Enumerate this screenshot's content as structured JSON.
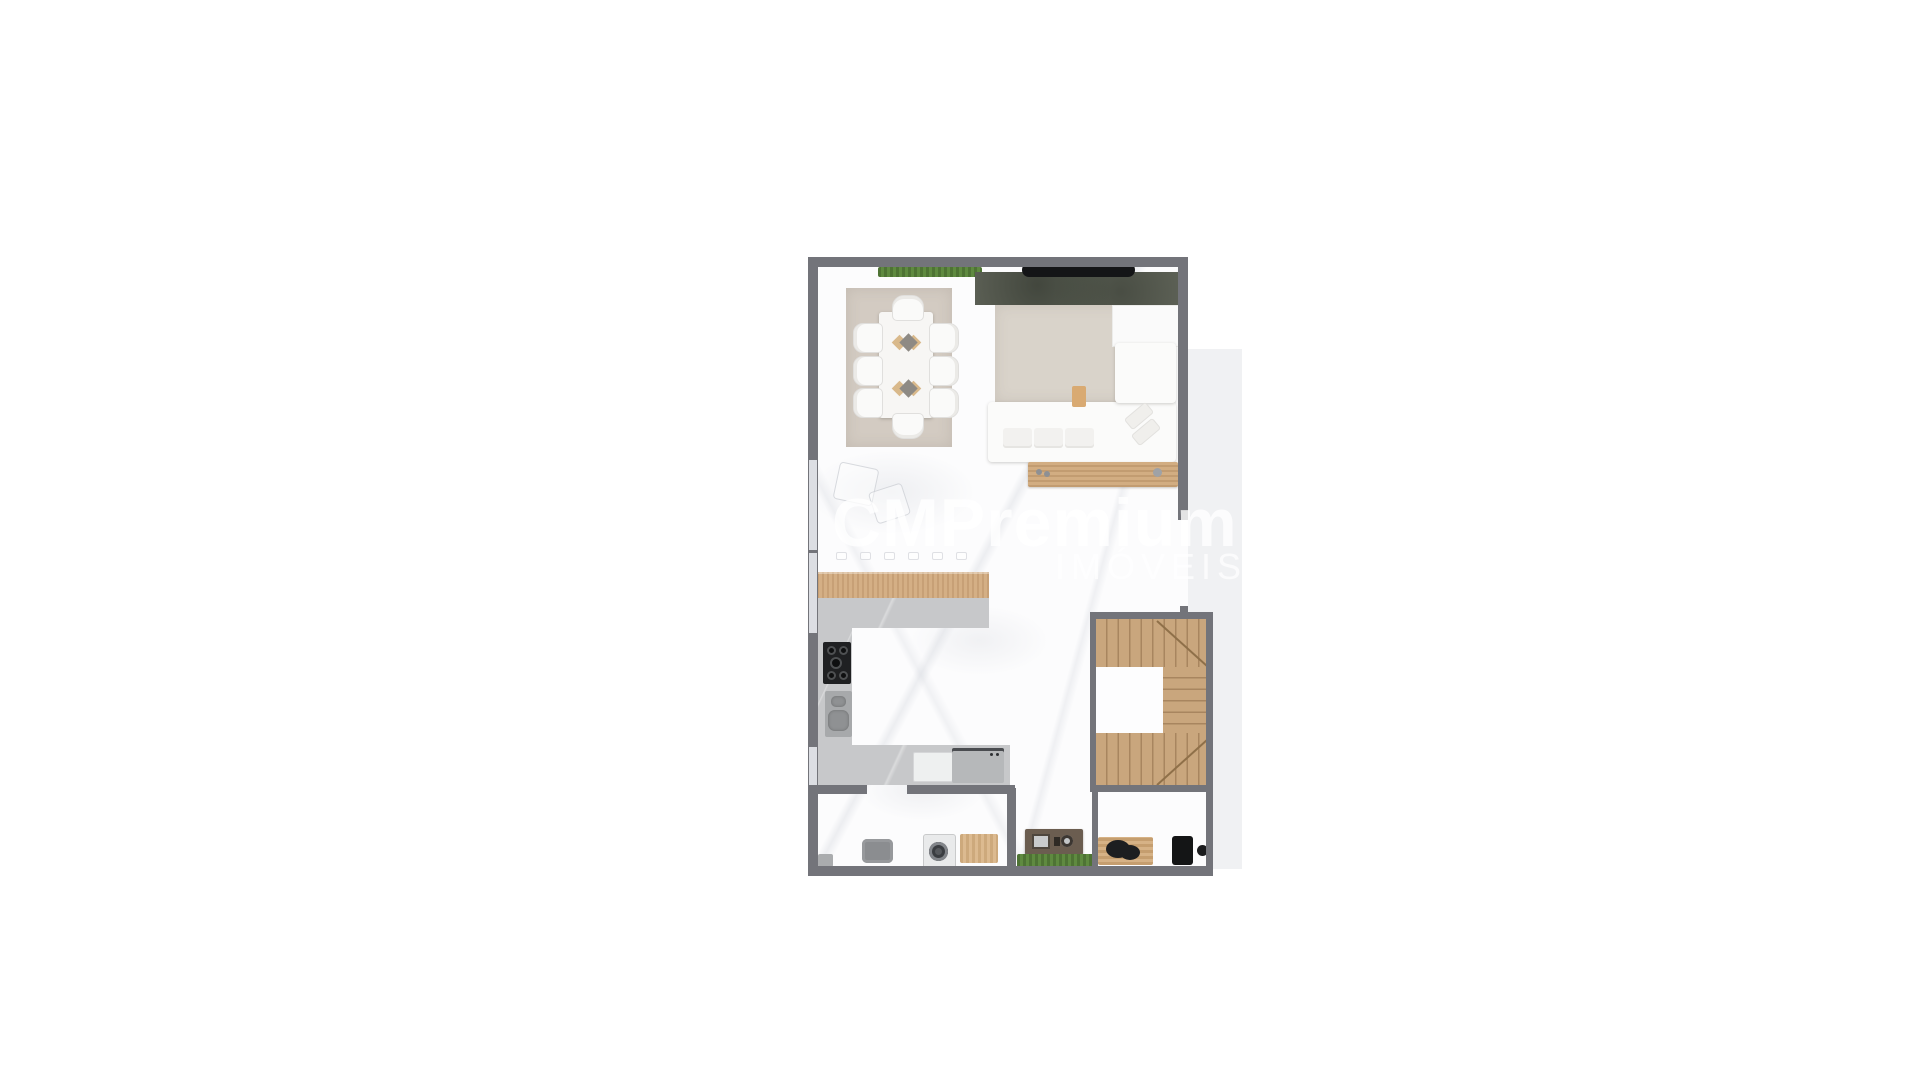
{
  "watermark": {
    "brand": "CMPremium",
    "subtitle": "IMÓVEIS"
  },
  "colors": {
    "background": "#ffffff",
    "wall": "#73747a",
    "window": "#dcdee3",
    "floor": "#fcfcfd",
    "exterior_patio": "#f0f1f3",
    "rug_dining": "#d3cbc2",
    "rug_living": "#d9d3ca",
    "tv_panel": "#5e6257",
    "tv": "#141517",
    "hedge": "#5a7c3c",
    "wood": "#cda87e",
    "stair_wood": "#c9a67d",
    "counter": "#c7c8ca",
    "cooktop": "#1f2022",
    "appliance_steel": "#b6b8ba",
    "white_furniture": "#fbfbfa",
    "watermark_text": "rgba(255,255,255,0.8)"
  },
  "floor_plan": {
    "type": "residential-apartment-ground-floor-top-view-render",
    "rooms": [
      {
        "name": "dining-area",
        "furniture": [
          "area-rug",
          "dining-table",
          "dining-chairs-x8",
          "table-runner-decor",
          "planter-hedge"
        ]
      },
      {
        "name": "living-area",
        "furniture": [
          "tv-feature-wall",
          "tv",
          "area-rug",
          "l-shaped-sectional-sofa",
          "seat-cushions",
          "throw-pillows",
          "wood-side-table",
          "wood-console",
          "sideboard"
        ]
      },
      {
        "name": "kitchen",
        "furniture": [
          "wood-bar-counter",
          "bar-stool-marks",
          "l-shaped-counter",
          "cooktop",
          "sink",
          "dishwasher",
          "steel-range",
          "windows"
        ]
      },
      {
        "name": "staircase",
        "furniture": [
          "u-shaped-wood-stairs",
          "winder-treads",
          "landing-void"
        ]
      },
      {
        "name": "laundry-room",
        "furniture": [
          "waste-bin",
          "laundry-tank",
          "washing-machine",
          "wood-deck-mat"
        ]
      },
      {
        "name": "terrace-strip",
        "furniture": [
          "built-in-grill-cabinet",
          "hedge-planter"
        ]
      },
      {
        "name": "barbecue-area",
        "furniture": [
          "wood-prep-table",
          "kettle-grill",
          "mini-fridge",
          "round-stool"
        ]
      }
    ]
  }
}
